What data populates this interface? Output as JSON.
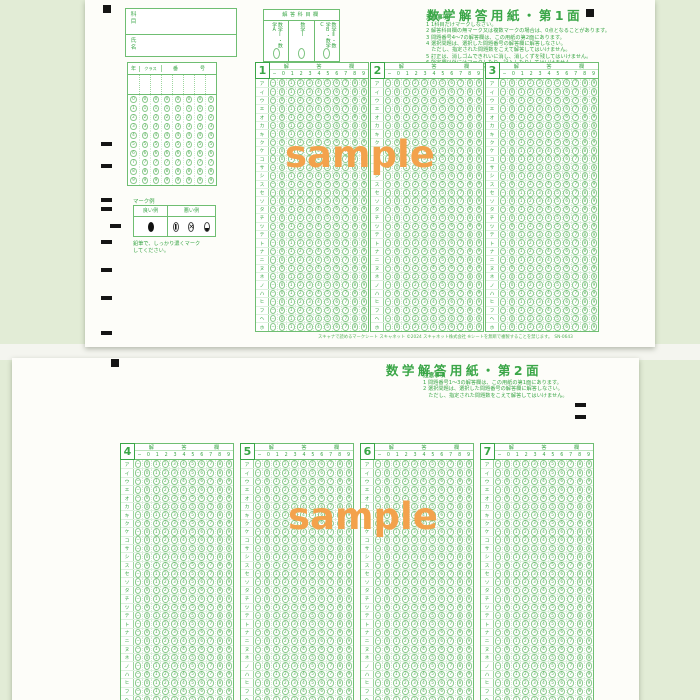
{
  "colors": {
    "print_green": "#3aa647",
    "line_green": "#6fbe72",
    "bubble_green": "#8ccb8e",
    "desk_background": "#e2ecd6",
    "paper": "#fdfdf9",
    "watermark_orange": "#f3a24c",
    "registration_black": "#151515"
  },
  "watermark": {
    "text": "sample"
  },
  "icons": {
    "bad_cross": "✕"
  },
  "sheet1": {
    "title": "数学解答用紙・第1面",
    "subject_label": "科目",
    "name_label": "氏名",
    "subject_section": {
      "header": "解答科目欄",
      "options": [
        "数学Ⅰ・数学A",
        "数学Ⅰ",
        "数学Ⅱ・数学B・数学C"
      ]
    },
    "notes_title": "注意事項",
    "notes": "1 1科目だけマークしなさい。\n2 解答科目欄の無マーク又は複数マークの場合は、0点となることがあります。\n3 問題番号4～7の解答欄は、この用紙の第2面にあります。\n4 選択問題は、選択した問題番号の解答欄に解答しなさい。\n　ただし、指定された問題数をこえて解答してはいけません。\n5 訂正は、消しゴムできれいに消し、消しくずを残してはいけません。\n6 所定欄以外にはマークしたり、記入したりしてはいけません。\n7 汚したり、折りまげたりしてはいけません。",
    "id_grid": {
      "year_label": "年",
      "class_label": "クラス",
      "number_label": "番号",
      "digits": [
        "0",
        "1",
        "2",
        "3",
        "4",
        "5",
        "6",
        "7",
        "8",
        "9"
      ],
      "columns": 8
    },
    "mark_example": {
      "title": "マーク例",
      "good_label": "良い例",
      "bad_label": "悪い例",
      "note": "鉛筆で、しっかり濃くマーク\nしてください。"
    },
    "question_numbers": [
      "1",
      "2",
      "3"
    ],
    "footer": "スキャナで読めるマークシート スキャネット ©2024 スキャネット株式会社 ※シートを無断で複製することを禁じます。　SN-0643"
  },
  "sheet2": {
    "title": "数学解答用紙・第2面",
    "notes_title": "注意事項",
    "notes": "1 問題番号1～3の解答欄は、この用紙の第1面にあります。\n2 選択問題は、選択した問題番号の解答欄に解答しなさい。\n　ただし、指定された問題数をこえて解答してはいけません。",
    "question_numbers": [
      "4",
      "5",
      "6",
      "7"
    ]
  },
  "answer_grid": {
    "header_chars": [
      "解",
      "答",
      "欄"
    ],
    "col_labels": [
      "−",
      "0",
      "1",
      "2",
      "3",
      "4",
      "5",
      "6",
      "7",
      "8",
      "9"
    ],
    "row_labels": [
      "ア",
      "イ",
      "ウ",
      "エ",
      "オ",
      "カ",
      "キ",
      "ク",
      "ケ",
      "コ",
      "サ",
      "シ",
      "ス",
      "セ",
      "ソ",
      "タ",
      "チ",
      "ツ",
      "テ",
      "ト",
      "ナ",
      "ニ",
      "ヌ",
      "ネ",
      "ノ",
      "ハ",
      "ヒ",
      "フ",
      "ヘ",
      "ホ"
    ]
  }
}
